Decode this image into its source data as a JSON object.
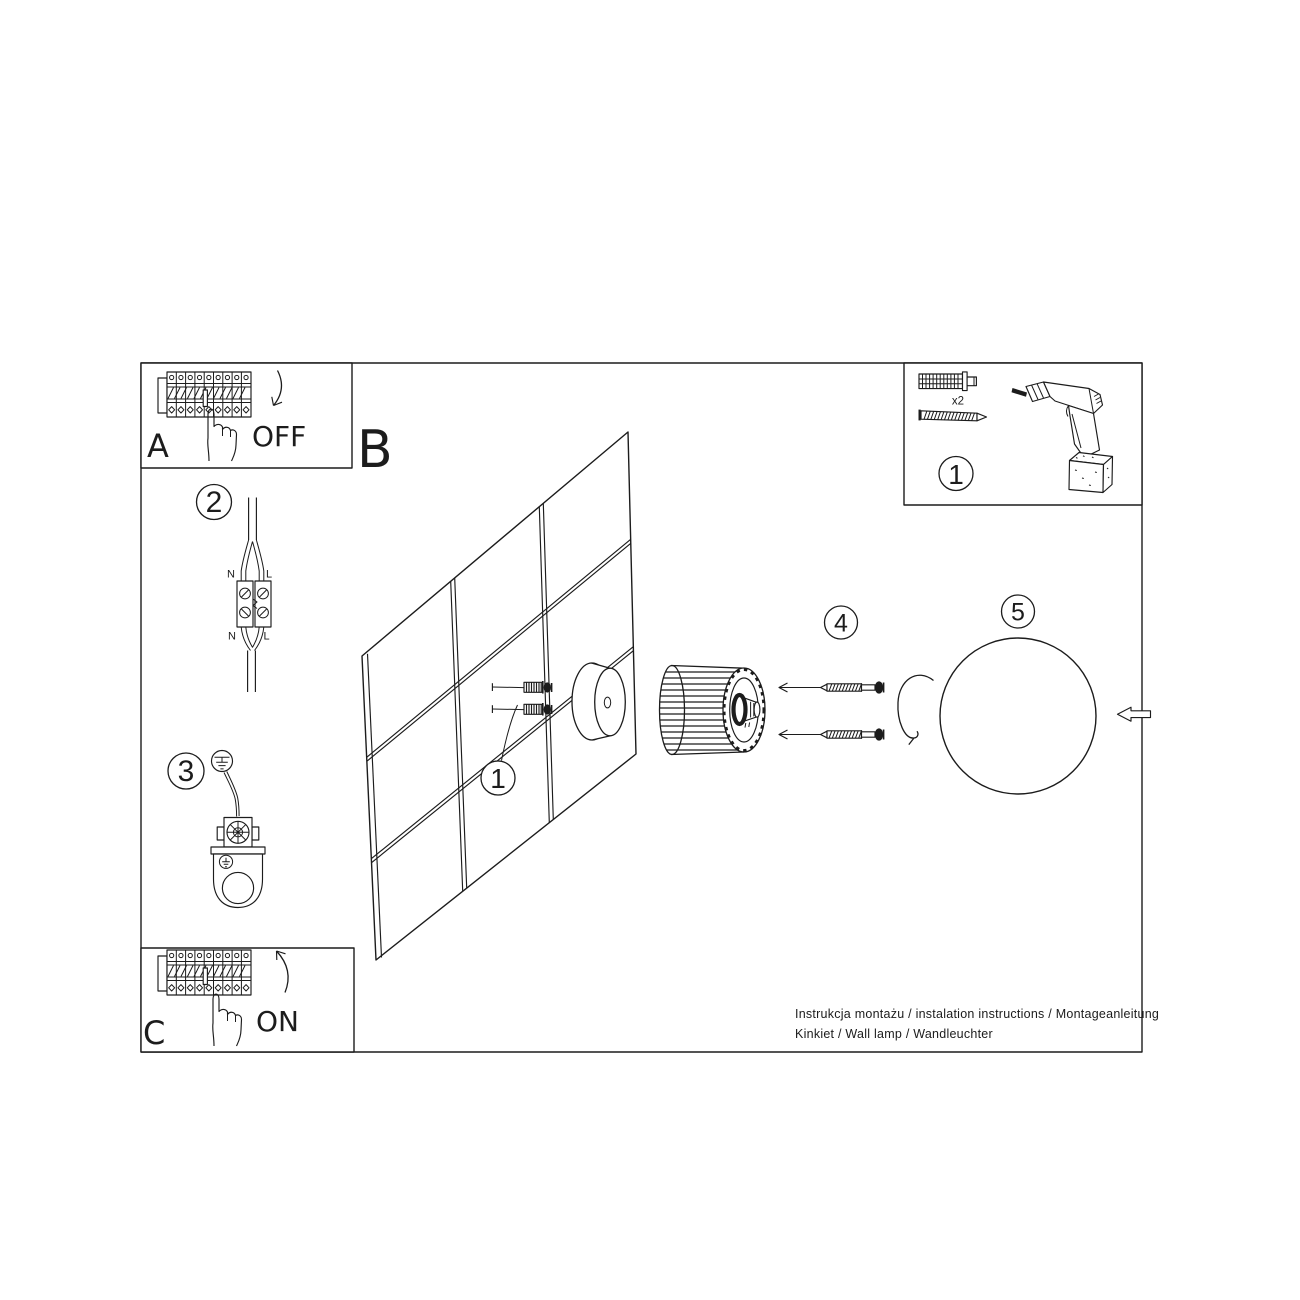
{
  "meta": {
    "background_color": "#ffffff",
    "line_color": "#1c1c1c",
    "document_kind": "wall lamp installation instructions"
  },
  "sections": {
    "a": {
      "label": "A",
      "action": "OFF"
    },
    "b": {
      "label": "B"
    },
    "c": {
      "label": "C",
      "action": "ON"
    }
  },
  "step_numbers": {
    "one": "1",
    "two": "2",
    "three": "3",
    "four": "4",
    "five": "5"
  },
  "wiring": {
    "neutral": "N",
    "live": "L"
  },
  "toolbox": {
    "quantity_label": "x2"
  },
  "footer": {
    "line1": "Instrukcja montażu / instalation instructions / Montageanleitung",
    "line2": "Kinkiet / Wall lamp / Wandleuchter"
  }
}
